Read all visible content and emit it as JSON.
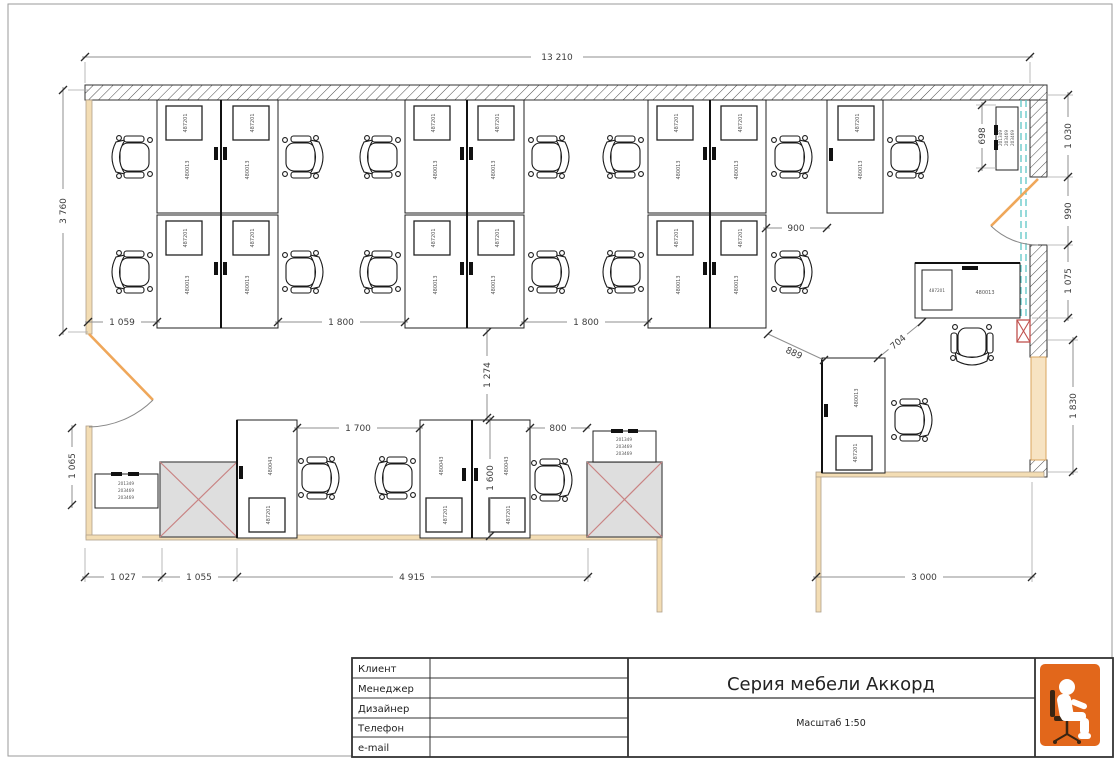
{
  "drawing": {
    "title": "Серия мебели Аккорд",
    "scale_label": "Масштаб 1:50"
  },
  "title_block": {
    "fields": [
      {
        "label": "Клиент",
        "value": ""
      },
      {
        "label": "Менеджер",
        "value": ""
      },
      {
        "label": "Дизайнер",
        "value": ""
      },
      {
        "label": "Телефон",
        "value": ""
      },
      {
        "label": "e-mail",
        "value": ""
      }
    ]
  },
  "dims": {
    "total_width": "13 210",
    "total_height": "3 760",
    "left_door": "1 065",
    "offset_1059": "1 059",
    "gap_1800a": "1 800",
    "gap_1800b": "1 800",
    "gap_900": "900",
    "diag_889": "889",
    "diag_704": "704",
    "gap_1700": "1 700",
    "gap_800": "800",
    "row_gap_1274": "1 274",
    "desk_1600": "1 600",
    "cab_698": "698",
    "bottom_1027": "1 027",
    "bottom_1055": "1 055",
    "bottom_4915": "4 915",
    "bottom_3000": "3 000",
    "right_1030": "1 030",
    "right_990": "990",
    "right_1075": "1 075",
    "right_1830": "1 830"
  },
  "codes": {
    "desk": "480013",
    "desk_small": "480043",
    "pedestal": "487201",
    "cabinet_line1": "201349",
    "cabinet_line2": "203469",
    "cabinet_line3": "203469"
  },
  "colors": {
    "accent_orange": "#e2671b",
    "wall_wood": "#f3ddb4",
    "door_leaf": "#efa75a",
    "glass": "#5ec7c7",
    "column_fill": "#dedede",
    "cross_red": "#c0504d"
  }
}
